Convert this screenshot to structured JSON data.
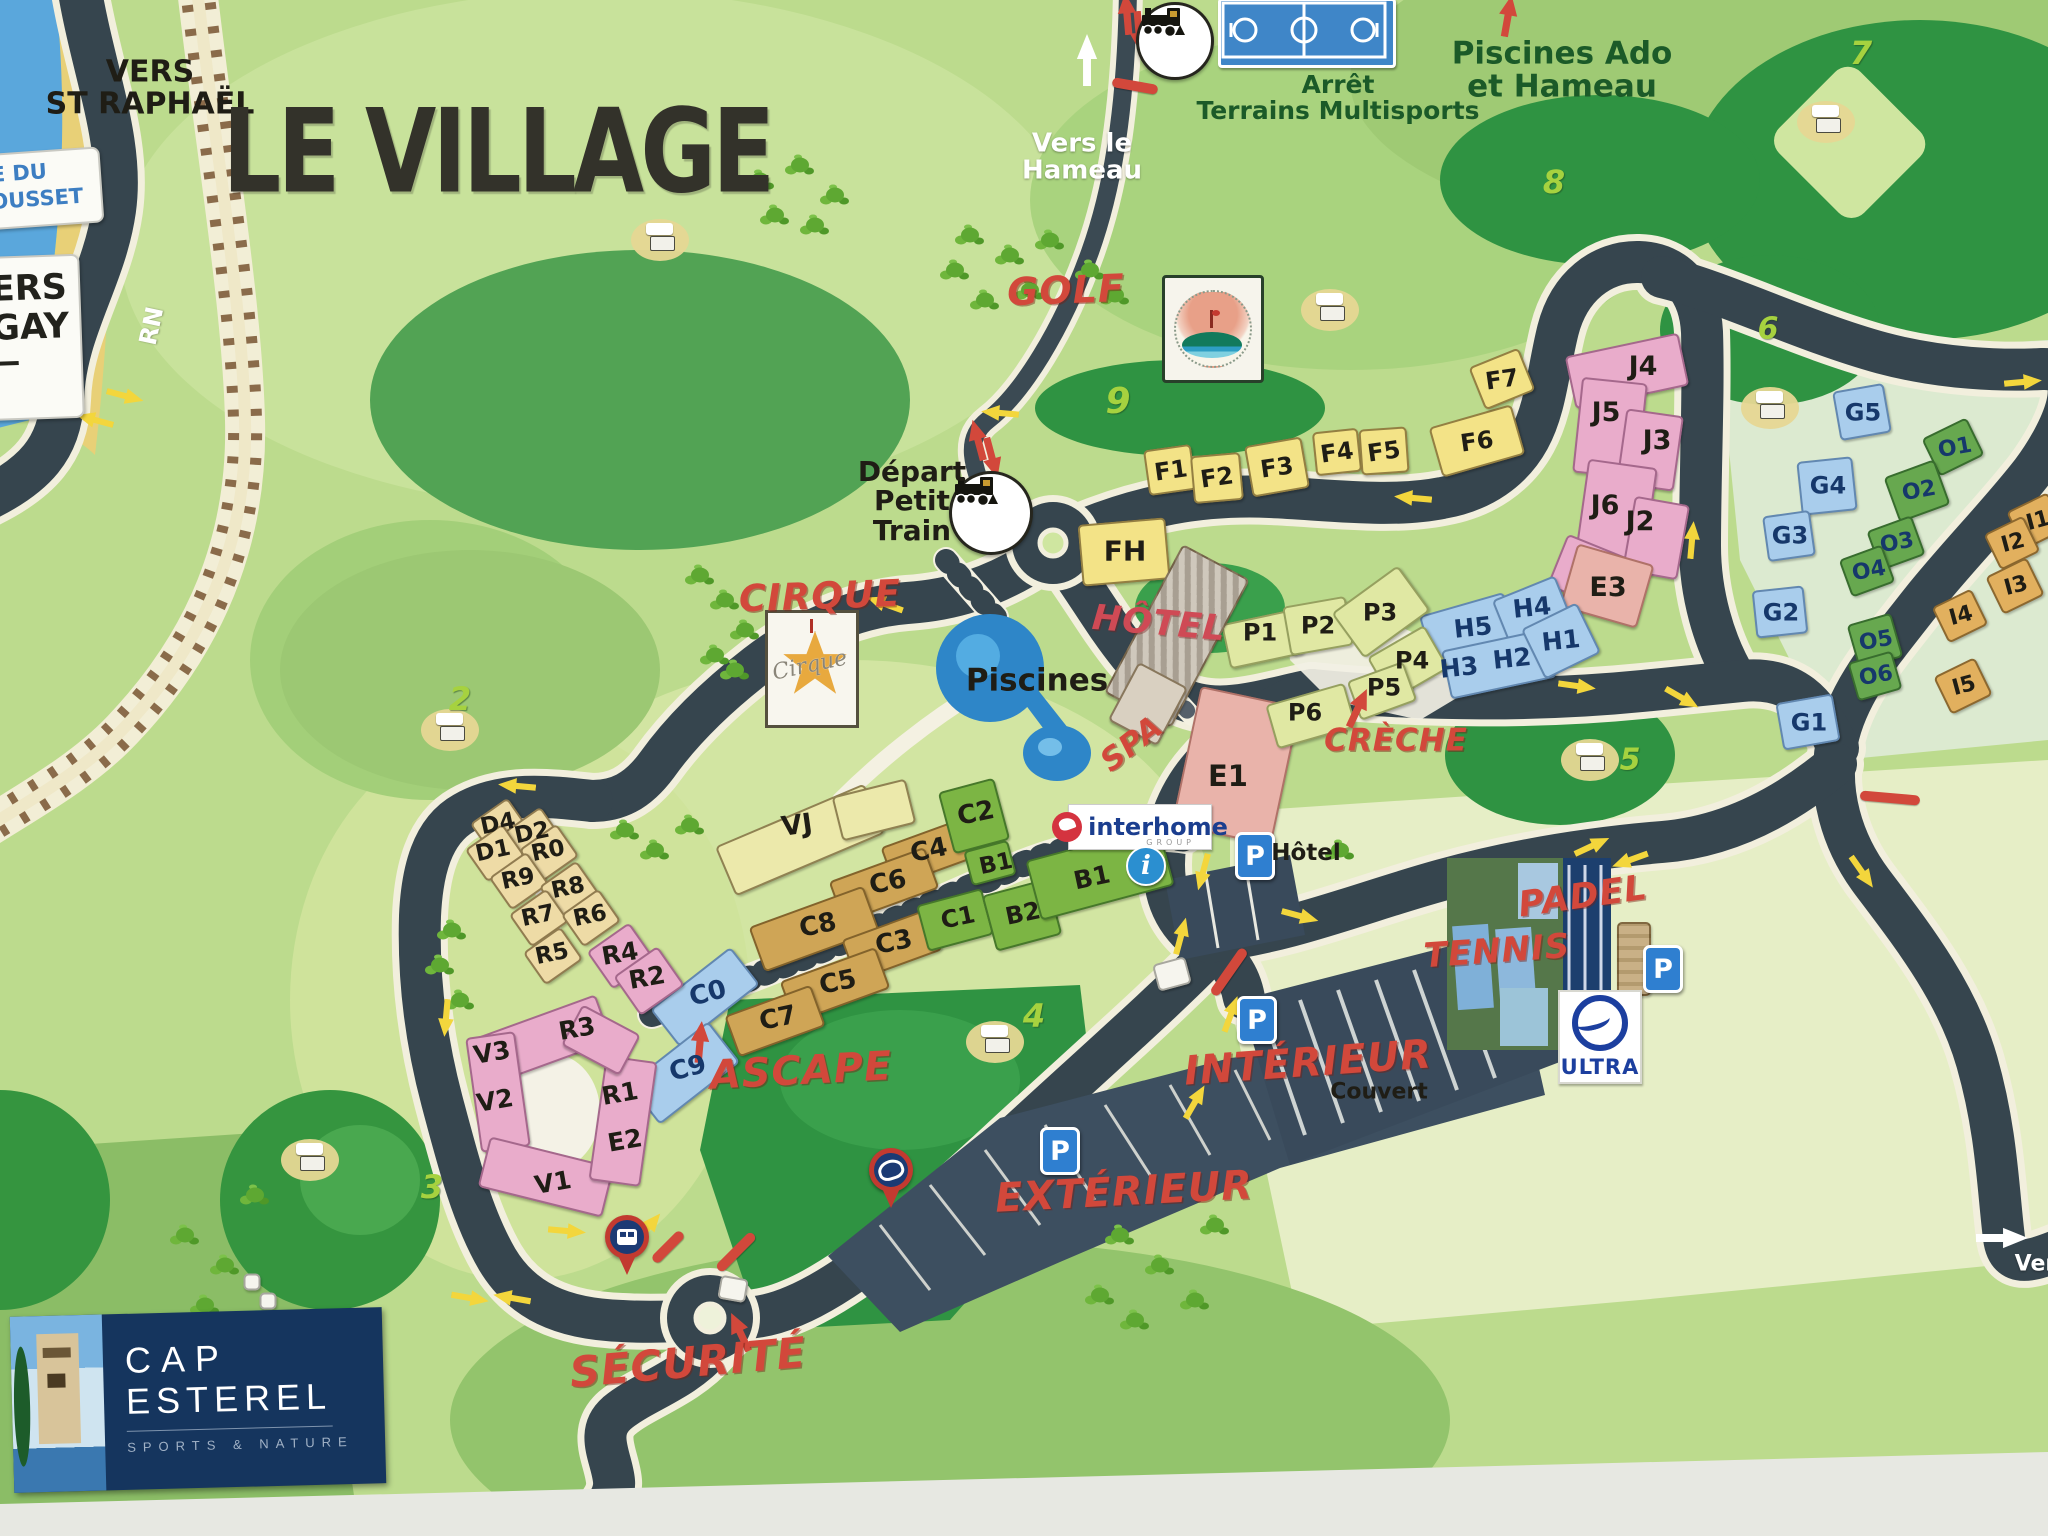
{
  "title": "LE VILLAGE",
  "signs": {
    "coast_sign": "E DU\nRROUSSET",
    "vers_agay": "VERS\nAGAY"
  },
  "logos": {
    "cap_esterel": {
      "line1": "CAP",
      "line2": "ESTEREL",
      "tagline": "SPORTS & NATURE"
    },
    "interhome": {
      "name": "interhome",
      "sub": "GROUP"
    },
    "ultra": {
      "name": "ULTRA"
    },
    "golf_badge": {
      "name": "Golf Roches d'Azur Cap Esterel"
    },
    "cirque_badge": {
      "name": "Cirque"
    }
  },
  "parking": {
    "letter": "P"
  },
  "info": {
    "letter": "i"
  },
  "labels": [
    [
      "VERS\nST RAPHAËL",
      150,
      88,
      30,
      "k",
      0
    ],
    [
      "LE VILLAGE",
      497,
      153,
      98,
      "t",
      0
    ],
    [
      "RN",
      152,
      326,
      24,
      "w",
      -78
    ],
    [
      "Vers le\nHameau",
      1082,
      158,
      26,
      "w",
      0
    ],
    [
      "Arrêt\nTerrains Multisports",
      1338,
      98,
      25,
      "g",
      0
    ],
    [
      "Piscines Ado\net Hameau",
      1562,
      70,
      31,
      "g",
      0
    ],
    [
      "Départ\nPetit\nTrain",
      912,
      501,
      28,
      "k",
      0
    ],
    [
      "GOLF",
      1066,
      291,
      38,
      "r",
      -2
    ],
    [
      "CIRQUE",
      820,
      597,
      37,
      "r",
      -2
    ],
    [
      "Piscines",
      1037,
      681,
      31,
      "k",
      0
    ],
    [
      "SPA",
      1132,
      744,
      31,
      "r",
      -38
    ],
    [
      "HÔTEL",
      1159,
      624,
      35,
      "r2",
      5
    ],
    [
      "CRÈCHE",
      1396,
      741,
      31,
      "r",
      0
    ],
    [
      "ASCAPE",
      801,
      1071,
      40,
      "r",
      -3
    ],
    [
      "TENNIS",
      1497,
      952,
      34,
      "r",
      -4
    ],
    [
      "PADEL",
      1583,
      897,
      35,
      "r",
      -8
    ],
    [
      "INTÉRIEUR",
      1308,
      1063,
      40,
      "r",
      -4
    ],
    [
      "Couvert",
      1379,
      1092,
      22,
      "k",
      0
    ],
    [
      "EXTÉRIEUR",
      1124,
      1192,
      40,
      "r",
      -3
    ],
    [
      "SÉCURITÉ",
      688,
      1363,
      42,
      "r",
      -5
    ],
    [
      "Hôtel",
      1306,
      853,
      23,
      "k",
      0
    ],
    [
      "Vers",
      2042,
      1264,
      22,
      "w",
      0
    ],
    [
      "VJ",
      797,
      826,
      27,
      "k",
      -8
    ],
    [
      "FH",
      1125,
      551,
      28,
      "k",
      0
    ],
    [
      "F1",
      1171,
      471,
      24,
      "k",
      -8
    ],
    [
      "F2",
      1217,
      478,
      24,
      "k",
      -8
    ],
    [
      "F3",
      1277,
      468,
      24,
      "k",
      -8
    ],
    [
      "F4",
      1337,
      453,
      24,
      "k",
      -8
    ],
    [
      "F5",
      1384,
      452,
      24,
      "k",
      -8
    ],
    [
      "F6",
      1477,
      442,
      24,
      "k",
      -8
    ],
    [
      "F7",
      1502,
      380,
      24,
      "k",
      -8
    ],
    [
      "J4",
      1643,
      367,
      27,
      "k",
      0
    ],
    [
      "J5",
      1606,
      413,
      27,
      "k",
      0
    ],
    [
      "J3",
      1657,
      441,
      27,
      "k",
      0
    ],
    [
      "J6",
      1605,
      506,
      27,
      "k",
      0
    ],
    [
      "J2",
      1640,
      522,
      27,
      "k",
      0
    ],
    [
      "E3",
      1608,
      588,
      27,
      "k",
      0
    ],
    [
      "E1",
      1228,
      776,
      29,
      "k",
      0
    ],
    [
      "H5",
      1473,
      628,
      25,
      "n",
      -6
    ],
    [
      "H4",
      1532,
      608,
      25,
      "n",
      -6
    ],
    [
      "H3",
      1459,
      668,
      25,
      "n",
      -6
    ],
    [
      "H2",
      1512,
      659,
      25,
      "n",
      -6
    ],
    [
      "H1",
      1561,
      641,
      25,
      "n",
      -6
    ],
    [
      "P1",
      1260,
      633,
      24,
      "k",
      0
    ],
    [
      "P2",
      1318,
      626,
      24,
      "k",
      0
    ],
    [
      "P3",
      1380,
      613,
      24,
      "k",
      0
    ],
    [
      "P4",
      1412,
      661,
      24,
      "k",
      0
    ],
    [
      "P5",
      1384,
      688,
      24,
      "k",
      0
    ],
    [
      "P6",
      1305,
      713,
      24,
      "k",
      0
    ],
    [
      "G5",
      1863,
      413,
      24,
      "n",
      0
    ],
    [
      "G4",
      1828,
      486,
      24,
      "n",
      0
    ],
    [
      "G3",
      1790,
      536,
      24,
      "n",
      0
    ],
    [
      "G2",
      1781,
      613,
      24,
      "n",
      0
    ],
    [
      "G1",
      1809,
      723,
      24,
      "n",
      0
    ],
    [
      "O1",
      1955,
      448,
      22,
      "n",
      -10
    ],
    [
      "O2",
      1919,
      491,
      22,
      "n",
      -10
    ],
    [
      "O3",
      1897,
      543,
      22,
      "n",
      -10
    ],
    [
      "O4",
      1869,
      571,
      22,
      "n",
      -10
    ],
    [
      "O5",
      1876,
      641,
      22,
      "n",
      -10
    ],
    [
      "O6",
      1876,
      676,
      22,
      "n",
      -10
    ],
    [
      "I1",
      2038,
      521,
      22,
      "k",
      -15
    ],
    [
      "I2",
      2013,
      543,
      22,
      "k",
      -15
    ],
    [
      "I3",
      2016,
      586,
      22,
      "k",
      -15
    ],
    [
      "I4",
      1961,
      616,
      22,
      "k",
      -15
    ],
    [
      "I5",
      1964,
      686,
      22,
      "k",
      -15
    ],
    [
      "C2",
      976,
      814,
      26,
      "k",
      -12
    ],
    [
      "C4",
      929,
      851,
      26,
      "k",
      -12
    ],
    [
      "C6",
      888,
      883,
      26,
      "k",
      -12
    ],
    [
      "C8",
      818,
      926,
      26,
      "k",
      -12
    ],
    [
      "C3",
      894,
      943,
      26,
      "k",
      -12
    ],
    [
      "C5",
      838,
      983,
      26,
      "k",
      -12
    ],
    [
      "C7",
      778,
      1019,
      26,
      "k",
      -12
    ],
    [
      "C1",
      958,
      918,
      24,
      "k",
      -12
    ],
    [
      "B2",
      1023,
      914,
      24,
      "k",
      -12
    ],
    [
      "B1",
      996,
      864,
      23,
      "k",
      -12
    ],
    [
      "B1",
      1092,
      878,
      25,
      "k",
      -12
    ],
    [
      "C0",
      708,
      994,
      26,
      "n",
      -15
    ],
    [
      "C9",
      688,
      1069,
      26,
      "n",
      -15
    ],
    [
      "D4",
      498,
      824,
      23,
      "k",
      -12
    ],
    [
      "D2",
      532,
      833,
      23,
      "k",
      -12
    ],
    [
      "D1",
      493,
      851,
      23,
      "k",
      -12
    ],
    [
      "R0",
      548,
      851,
      23,
      "k",
      -12
    ],
    [
      "R9",
      518,
      879,
      23,
      "k",
      -12
    ],
    [
      "R8",
      568,
      888,
      23,
      "k",
      -12
    ],
    [
      "R7",
      538,
      916,
      23,
      "k",
      -12
    ],
    [
      "R6",
      590,
      916,
      23,
      "k",
      -12
    ],
    [
      "R5",
      552,
      954,
      23,
      "k",
      -12
    ],
    [
      "R4",
      620,
      954,
      25,
      "k",
      -10
    ],
    [
      "R2",
      647,
      978,
      25,
      "k",
      -10
    ],
    [
      "R3",
      577,
      1029,
      25,
      "k",
      -10
    ],
    [
      "R1",
      620,
      1094,
      25,
      "k",
      -10
    ],
    [
      "E2",
      625,
      1141,
      25,
      "k",
      -10
    ],
    [
      "V3",
      492,
      1053,
      25,
      "k",
      -10
    ],
    [
      "V2",
      495,
      1101,
      25,
      "k",
      -10
    ],
    [
      "V1",
      553,
      1183,
      25,
      "k",
      -10
    ],
    [
      "2",
      460,
      700,
      32,
      "h",
      0
    ],
    [
      "3",
      432,
      1188,
      32,
      "h",
      0
    ],
    [
      "4",
      1034,
      1017,
      32,
      "h",
      0
    ],
    [
      "5",
      1630,
      760,
      30,
      "h",
      0
    ],
    [
      "6",
      1768,
      329,
      30,
      "h",
      0
    ],
    [
      "7",
      1861,
      54,
      32,
      "h",
      0
    ],
    [
      "8",
      1554,
      183,
      32,
      "h",
      0
    ],
    [
      "9",
      1118,
      402,
      36,
      "h",
      0
    ]
  ],
  "buildings": [
    [
      1170,
      470,
      44,
      42,
      -8,
      "y"
    ],
    [
      1217,
      478,
      46,
      44,
      -5,
      "y"
    ],
    [
      1277,
      467,
      54,
      48,
      -10,
      "y"
    ],
    [
      1337,
      452,
      42,
      40,
      -6,
      "y"
    ],
    [
      1384,
      451,
      44,
      42,
      -4,
      "y"
    ],
    [
      1477,
      441,
      82,
      48,
      -16,
      "y"
    ],
    [
      1502,
      379,
      50,
      42,
      -22,
      "y"
    ],
    [
      1124,
      552,
      84,
      58,
      -5,
      "y"
    ],
    [
      800,
      840,
      158,
      50,
      -23,
      "vj"
    ],
    [
      874,
      810,
      72,
      42,
      -14,
      "vj"
    ],
    [
      1627,
      371,
      112,
      50,
      -12,
      "pk"
    ],
    [
      1610,
      428,
      62,
      92,
      6,
      "pk"
    ],
    [
      1650,
      450,
      54,
      72,
      8,
      "pk"
    ],
    [
      1616,
      514,
      66,
      98,
      8,
      "pk"
    ],
    [
      1656,
      538,
      52,
      72,
      10,
      "pk"
    ],
    [
      1588,
      572,
      62,
      52,
      22,
      "pk"
    ],
    [
      1607,
      586,
      76,
      62,
      16,
      "sa"
    ],
    [
      1236,
      766,
      98,
      138,
      12,
      "sa"
    ],
    [
      1469,
      631,
      84,
      52,
      -16,
      "bl"
    ],
    [
      1533,
      612,
      64,
      48,
      -22,
      "bl"
    ],
    [
      1499,
      664,
      104,
      46,
      -12,
      "bl"
    ],
    [
      1561,
      641,
      58,
      52,
      -26,
      "bl"
    ],
    [
      1263,
      639,
      72,
      42,
      -12,
      "lm"
    ],
    [
      1318,
      626,
      60,
      46,
      -10,
      "lm"
    ],
    [
      1381,
      612,
      78,
      52,
      -36,
      "lm"
    ],
    [
      1408,
      663,
      62,
      46,
      -30,
      "lm"
    ],
    [
      1382,
      691,
      56,
      38,
      -20,
      "lm"
    ],
    [
      1311,
      716,
      78,
      42,
      -16,
      "lm"
    ],
    [
      1862,
      412,
      48,
      46,
      -10,
      "bl"
    ],
    [
      1827,
      486,
      52,
      50,
      -6,
      "bl"
    ],
    [
      1789,
      536,
      44,
      42,
      -8,
      "bl"
    ],
    [
      1780,
      612,
      48,
      44,
      -6,
      "bl"
    ],
    [
      1808,
      722,
      54,
      44,
      -10,
      "bl"
    ],
    [
      1953,
      447,
      46,
      38,
      -26,
      "og"
    ],
    [
      1917,
      491,
      50,
      44,
      -20,
      "og"
    ],
    [
      1896,
      543,
      44,
      38,
      -20,
      "og"
    ],
    [
      1867,
      571,
      42,
      36,
      -20,
      "og"
    ],
    [
      1875,
      641,
      42,
      42,
      -16,
      "og"
    ],
    [
      1875,
      676,
      42,
      36,
      -16,
      "og"
    ],
    [
      2036,
      521,
      42,
      38,
      -26,
      "io"
    ],
    [
      2012,
      543,
      40,
      36,
      -26,
      "io"
    ],
    [
      2015,
      586,
      42,
      38,
      -26,
      "io"
    ],
    [
      1960,
      616,
      40,
      36,
      -26,
      "io"
    ],
    [
      1963,
      686,
      42,
      38,
      -26,
      "io"
    ],
    [
      927,
      853,
      80,
      38,
      -20,
      "tn"
    ],
    [
      884,
      885,
      98,
      40,
      -20,
      "tn"
    ],
    [
      814,
      929,
      118,
      44,
      -20,
      "tn"
    ],
    [
      892,
      945,
      88,
      40,
      -20,
      "tn"
    ],
    [
      835,
      985,
      98,
      40,
      -20,
      "tn"
    ],
    [
      775,
      1021,
      88,
      40,
      -20,
      "tn"
    ],
    [
      705,
      997,
      98,
      44,
      -38,
      "bl"
    ],
    [
      684,
      1073,
      98,
      48,
      -38,
      "bl"
    ],
    [
      974,
      816,
      54,
      60,
      -15,
      "gr"
    ],
    [
      955,
      920,
      64,
      44,
      -15,
      "gr"
    ],
    [
      1022,
      915,
      64,
      54,
      -15,
      "gr"
    ],
    [
      1100,
      873,
      134,
      58,
      -15,
      "gr"
    ],
    [
      990,
      863,
      42,
      32,
      -15,
      "gr"
    ],
    [
      500,
      827,
      42,
      36,
      -35,
      "cr"
    ],
    [
      533,
      836,
      42,
      36,
      -35,
      "cr"
    ],
    [
      495,
      853,
      42,
      36,
      -35,
      "cr"
    ],
    [
      549,
      853,
      42,
      36,
      -35,
      "cr"
    ],
    [
      519,
      881,
      42,
      36,
      -35,
      "cr"
    ],
    [
      569,
      890,
      42,
      36,
      -35,
      "cr"
    ],
    [
      539,
      918,
      42,
      36,
      -35,
      "cr"
    ],
    [
      591,
      918,
      42,
      36,
      -35,
      "cr"
    ],
    [
      553,
      956,
      42,
      36,
      -35,
      "cr"
    ],
    [
      621,
      956,
      48,
      42,
      -35,
      "pk"
    ],
    [
      649,
      981,
      50,
      44,
      -35,
      "pk"
    ],
    [
      540,
      1041,
      132,
      46,
      -20,
      "pk"
    ],
    [
      498,
      1092,
      46,
      112,
      -8,
      "pk"
    ],
    [
      546,
      1177,
      124,
      48,
      14,
      "pk"
    ],
    [
      623,
      1121,
      48,
      122,
      8,
      "pk"
    ],
    [
      601,
      1040,
      62,
      42,
      28,
      "pk"
    ],
    [
      733,
      1289,
      24,
      20,
      10,
      "wh"
    ],
    [
      1172,
      974,
      30,
      24,
      -15,
      "wh"
    ],
    [
      252,
      1282,
      13,
      13,
      0,
      "wh"
    ],
    [
      268,
      1301,
      13,
      13,
      0,
      "wh"
    ],
    [
      1177,
      636,
      72,
      164,
      28,
      "ho"
    ],
    [
      1148,
      704,
      52,
      62,
      28,
      "ho2"
    ],
    [
      1634,
      959,
      30,
      70,
      0,
      "tb"
    ]
  ],
  "symbols": {
    "yellow_arrows": [
      [
        95,
        420,
        195
      ],
      [
        125,
        396,
        15
      ],
      [
        1000,
        413,
        185
      ],
      [
        885,
        604,
        200
      ],
      [
        517,
        786,
        185
      ],
      [
        446,
        1018,
        95
      ],
      [
        567,
        1231,
        5
      ],
      [
        648,
        1228,
        -50
      ],
      [
        470,
        1298,
        10
      ],
      [
        512,
        1298,
        190
      ],
      [
        1413,
        498,
        185
      ],
      [
        1692,
        540,
        -85
      ],
      [
        2023,
        382,
        -5
      ],
      [
        1577,
        686,
        8
      ],
      [
        1682,
        698,
        30
      ],
      [
        1862,
        872,
        55
      ],
      [
        1195,
        1102,
        -60
      ],
      [
        1203,
        872,
        105
      ],
      [
        1181,
        936,
        -75
      ],
      [
        1231,
        1014,
        -70
      ],
      [
        1300,
        916,
        15
      ],
      [
        1592,
        846,
        -25
      ],
      [
        1630,
        860,
        160
      ]
    ],
    "red_arrows": [
      [
        700,
        1042,
        -85
      ],
      [
        1358,
        708,
        -65
      ],
      [
        1508,
        16,
        -80
      ],
      [
        978,
        440,
        -105
      ],
      [
        992,
        458,
        75
      ],
      [
        1127,
        14,
        -95
      ],
      [
        1139,
        32,
        85
      ],
      [
        740,
        1332,
        -115
      ]
    ],
    "white_arrows": [
      [
        1087,
        60,
        -90
      ],
      [
        2002,
        1238,
        0
      ]
    ],
    "red_bars": [
      [
        1135,
        86,
        10,
        46
      ],
      [
        1890,
        798,
        5,
        60
      ],
      [
        1229,
        972,
        -55,
        55
      ],
      [
        736,
        1252,
        -45,
        50
      ],
      [
        668,
        1247,
        -45,
        40
      ]
    ],
    "parking_signs": [
      [
        1060,
        1151
      ],
      [
        1257,
        1020
      ],
      [
        1255,
        856
      ],
      [
        1663,
        969
      ]
    ],
    "train_stops": [
      [
        991,
        513,
        78
      ],
      [
        1175,
        41,
        72
      ]
    ],
    "pins": [
      [
        628,
        1272,
        "bus"
      ],
      [
        892,
        1205,
        "camera"
      ]
    ],
    "carts": [
      [
        660,
        240
      ],
      [
        450,
        730
      ],
      [
        310,
        1160
      ],
      [
        995,
        1042
      ],
      [
        1590,
        760
      ],
      [
        1770,
        408
      ],
      [
        1826,
        122
      ],
      [
        1330,
        310
      ]
    ],
    "trees": [
      [
        760,
        180
      ],
      [
        800,
        165
      ],
      [
        835,
        195
      ],
      [
        775,
        215
      ],
      [
        815,
        225
      ],
      [
        970,
        235
      ],
      [
        1010,
        255
      ],
      [
        1050,
        240
      ],
      [
        1090,
        270
      ],
      [
        1030,
        290
      ],
      [
        985,
        300
      ],
      [
        1115,
        295
      ],
      [
        955,
        270
      ],
      [
        700,
        575
      ],
      [
        725,
        600
      ],
      [
        745,
        630
      ],
      [
        715,
        655
      ],
      [
        735,
        670
      ],
      [
        625,
        830
      ],
      [
        655,
        850
      ],
      [
        690,
        825
      ],
      [
        452,
        930
      ],
      [
        440,
        965
      ],
      [
        460,
        1000
      ],
      [
        1340,
        850
      ],
      [
        185,
        1235
      ],
      [
        225,
        1265
      ],
      [
        205,
        1305
      ],
      [
        165,
        1335
      ],
      [
        255,
        1195
      ],
      [
        150,
        1430
      ],
      [
        185,
        1460
      ],
      [
        1120,
        1235
      ],
      [
        1160,
        1265
      ],
      [
        1195,
        1300
      ],
      [
        1100,
        1295
      ],
      [
        1215,
        1225
      ],
      [
        1135,
        1320
      ]
    ]
  }
}
